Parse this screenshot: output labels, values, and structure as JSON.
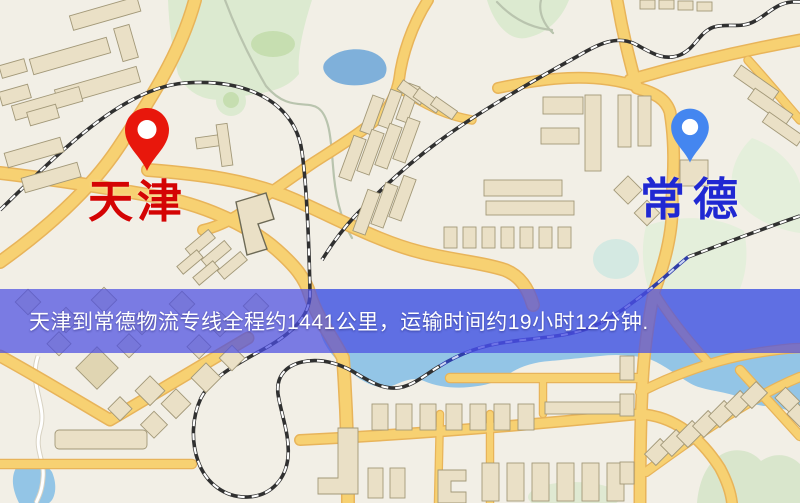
{
  "map": {
    "origin_marker": {
      "label": "天津",
      "pin_color": "#e8170c",
      "label_color": "#d40404"
    },
    "destination_marker": {
      "label": "常德",
      "pin_color": "#4486f0",
      "label_color": "#2028d2"
    },
    "banner": {
      "text": "天津到常德物流专线全程约1441公里，运输时间约19小时12分钟.",
      "bg_color": "#4b4ee2",
      "text_color": "#ffffff",
      "distance_km": "1441",
      "duration_hours": "19",
      "duration_minutes": "12"
    }
  }
}
